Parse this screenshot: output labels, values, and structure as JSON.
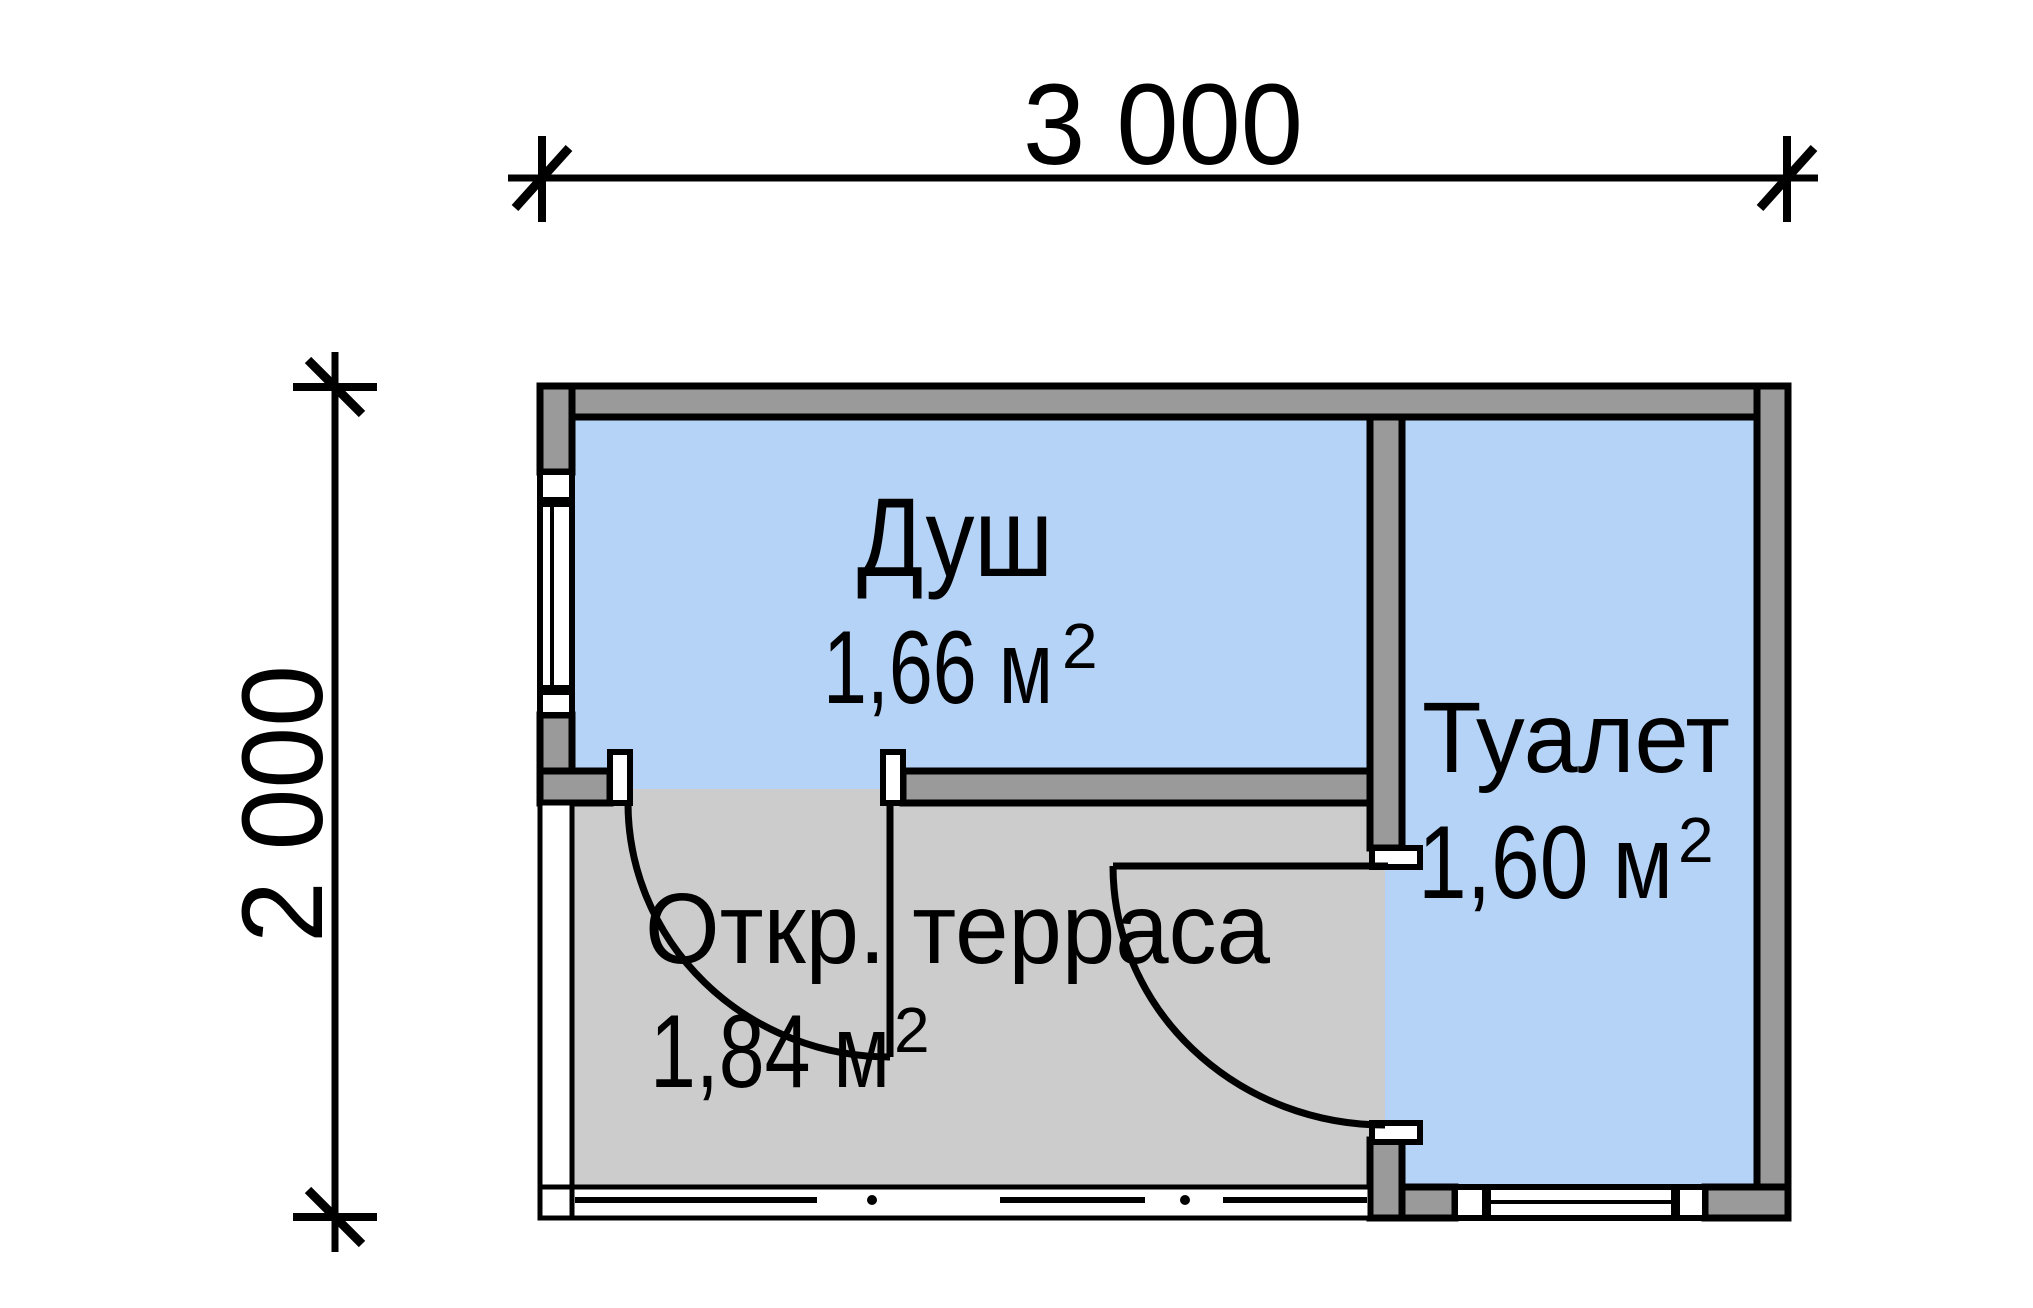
{
  "dimensions": {
    "width": {
      "label": "3 000"
    },
    "height": {
      "label": "2 000"
    }
  },
  "rooms": [
    {
      "name": "Душ",
      "area_value": "1,66 м",
      "area_exponent": "2",
      "floor_color": "#b5d3f7"
    },
    {
      "name": "Туалет",
      "area_value": "1,60 м",
      "area_exponent": "2",
      "floor_color": "#b5d3f7"
    },
    {
      "name": "Откр. терраса",
      "area_value": "1,84 м",
      "area_exponent": "2",
      "floor_color": "#cccccc"
    }
  ],
  "colors": {
    "background": "#ffffff",
    "wall_fill": "#9a9a9a",
    "opening_fill": "#ffffff",
    "outline": "#000000"
  }
}
